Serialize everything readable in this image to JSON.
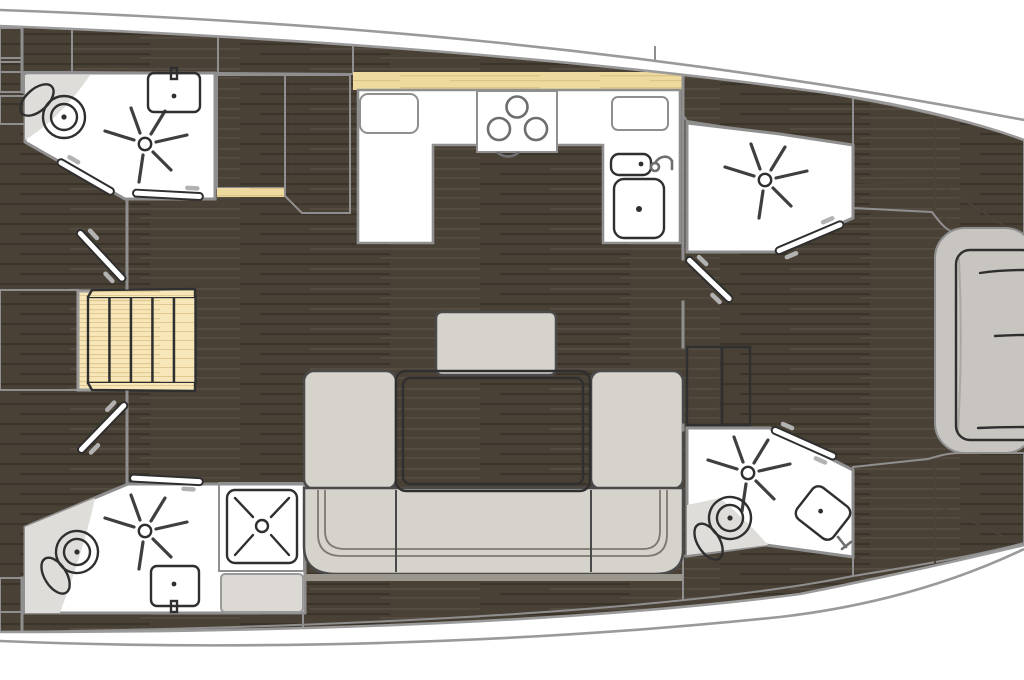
{
  "diagram": {
    "kind": "sailing-yacht-interior-floor-plan",
    "orientation": {
      "bow": "right",
      "stern": "left"
    },
    "rooms": [
      {
        "name": "aft-head-port",
        "fixtures": [
          "toilet",
          "washbasin",
          "shower-head",
          "door"
        ]
      },
      {
        "name": "companionway",
        "fixtures": [
          "steps",
          "platform",
          "door-port",
          "door-starboard"
        ],
        "steps_count": 5
      },
      {
        "name": "aft-head-starboard",
        "fixtures": [
          "toilet",
          "washbasin",
          "shower-head",
          "shower-stall",
          "bench",
          "door"
        ]
      },
      {
        "name": "galley",
        "fixtures": [
          "three-burner-stove",
          "small-sink",
          "large-sink",
          "faucet",
          "worktop",
          "locker",
          "wardrobe-panel"
        ]
      },
      {
        "name": "saloon",
        "fixtures": [
          "u-shaped-sofa",
          "dining-table",
          "seat-stool"
        ]
      },
      {
        "name": "forward-head-port",
        "fixtures": [
          "shower-head",
          "door"
        ]
      },
      {
        "name": "forward-head-starboard",
        "fixtures": [
          "toilet",
          "washbasin",
          "shower-head",
          "door"
        ]
      },
      {
        "name": "forward-cabin",
        "fixtures": [
          "v-berth-bed",
          "mattress",
          "hull-lockers"
        ]
      }
    ],
    "icons": [
      "shower-head-icon",
      "shower-drain-icon",
      "toilet-icon",
      "sink-icon",
      "stove-burners-icon",
      "faucet-icon",
      "door-swing-icon",
      "steps-icon",
      "bed-icon"
    ],
    "colors": {
      "hull_stroke": "#9a9a9a",
      "floor": "#4a4136",
      "wood": "#eeda9f",
      "wood_pale": "#f7e7b8",
      "wall": "#8f8f8f",
      "line_dark": "#2f2f2f",
      "white": "#ffffff",
      "fixture": "#efefef",
      "upholstery": "#d6d3cc",
      "upholstery_line": "#4a4a4a",
      "panel": "#d8d5d0",
      "bed_frame": "#c8c5c0",
      "platform": "#f0f0ef",
      "bench": "#dcd9d5",
      "table_rim": "#3c3731"
    }
  }
}
